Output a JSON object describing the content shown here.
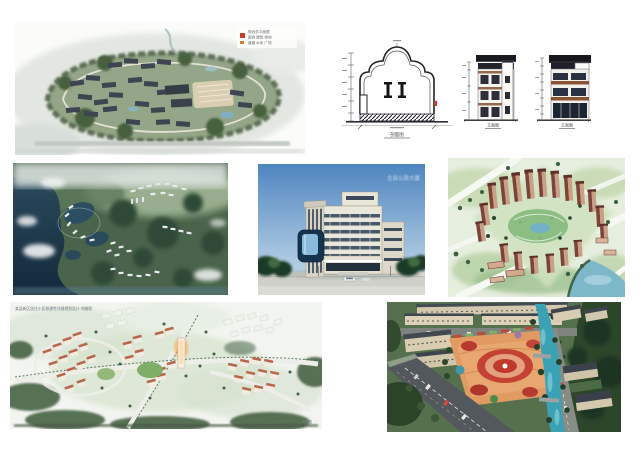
{
  "page": {
    "background": "#ffffff",
    "description": "collage page of seven architectural rendering images and drawings"
  },
  "colors": {
    "accent_red": "#c23b30",
    "plaza_orange": "#e09a62",
    "river_teal": "#3aa2b4",
    "lake_water": "#1d3a4c",
    "tree_green": "#2c462a",
    "roof_slate": "#3d4650",
    "tower_brick": "#7e4338",
    "sky_blue": "#5b8ec2",
    "drawing_ink": "#23232b"
  },
  "images": {
    "master_plan": {
      "name": "town-master-plan-rendering",
      "legend": {
        "seal_color": "#c3402f",
        "line1": "规划总平面图",
        "line2": "图例 建筑 绿地",
        "line3": "道路 水系 广场"
      }
    },
    "section_drawing": {
      "name": "gable-wall-section-drawing",
      "caption": "剖面图"
    },
    "elevation_front": {
      "name": "building-elevation-drawing-1",
      "caption": "立面图"
    },
    "elevation_side": {
      "name": "building-elevation-drawing-2",
      "caption": "立面图"
    },
    "lakeside_plan": {
      "name": "lakeside-resort-aerial-rendering"
    },
    "office_building": {
      "name": "office-building-rendering",
      "watermark": "全县公政大厦"
    },
    "residential_towers": {
      "name": "residential-towers-aerial-rendering"
    },
    "district_plan": {
      "name": "residential-district-birdview-rendering",
      "caption": "某县新区居住小区修建性详细规划设计 鸟瞰图",
      "corner_text": "鸟瞰图"
    },
    "plaza": {
      "name": "town-square-plaza-aerial-rendering"
    }
  }
}
